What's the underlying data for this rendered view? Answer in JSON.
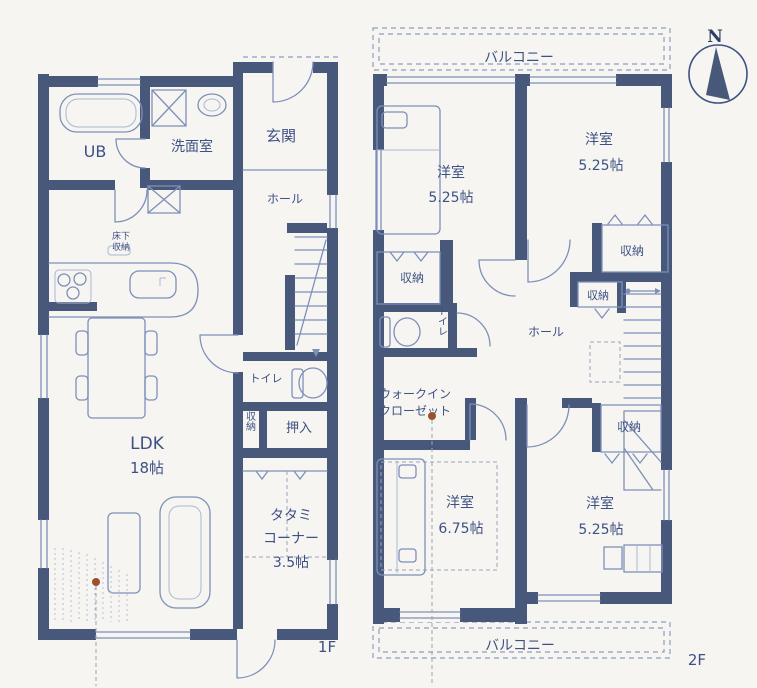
{
  "compass": {
    "north": "N"
  },
  "colors": {
    "wall": "#47587b",
    "line": "#7d90ba",
    "text": "#3d5185",
    "marker_dot": "#9a512e",
    "background": "#f7f5f1"
  },
  "floor1": {
    "label": "1F",
    "unit_bath": "UB",
    "washroom": "洗面室",
    "entrance": "玄関",
    "hall": "ホール",
    "toilet": "トイレ",
    "oshiire": "押入",
    "storage": "収納",
    "underfloor_storage_line1": "床下",
    "underfloor_storage_line2": "収納",
    "ldk_name": "LDK",
    "ldk_size": "18帖",
    "tatami_line1": "タタミ",
    "tatami_line2": "コーナー",
    "tatami_size": "3.5帖"
  },
  "floor2": {
    "label": "2F",
    "balcony_north": "バルコニー",
    "balcony_south": "バルコニー",
    "bedroom_nw_name": "洋室",
    "bedroom_nw_size": "5.25帖",
    "bedroom_ne_name": "洋室",
    "bedroom_ne_size": "5.25帖",
    "bedroom_sw_name": "洋室",
    "bedroom_sw_size": "6.75帖",
    "bedroom_se_name": "洋室",
    "bedroom_se_size": "5.25帖",
    "closet_nw": "収納",
    "closet_ne": "収納",
    "closet_hall": "収納",
    "closet_se": "収納",
    "toilet": "トイレ",
    "hall": "ホール",
    "walk_in_closet_line1": "ウォークイン",
    "walk_in_closet_line2": "クローゼット"
  }
}
